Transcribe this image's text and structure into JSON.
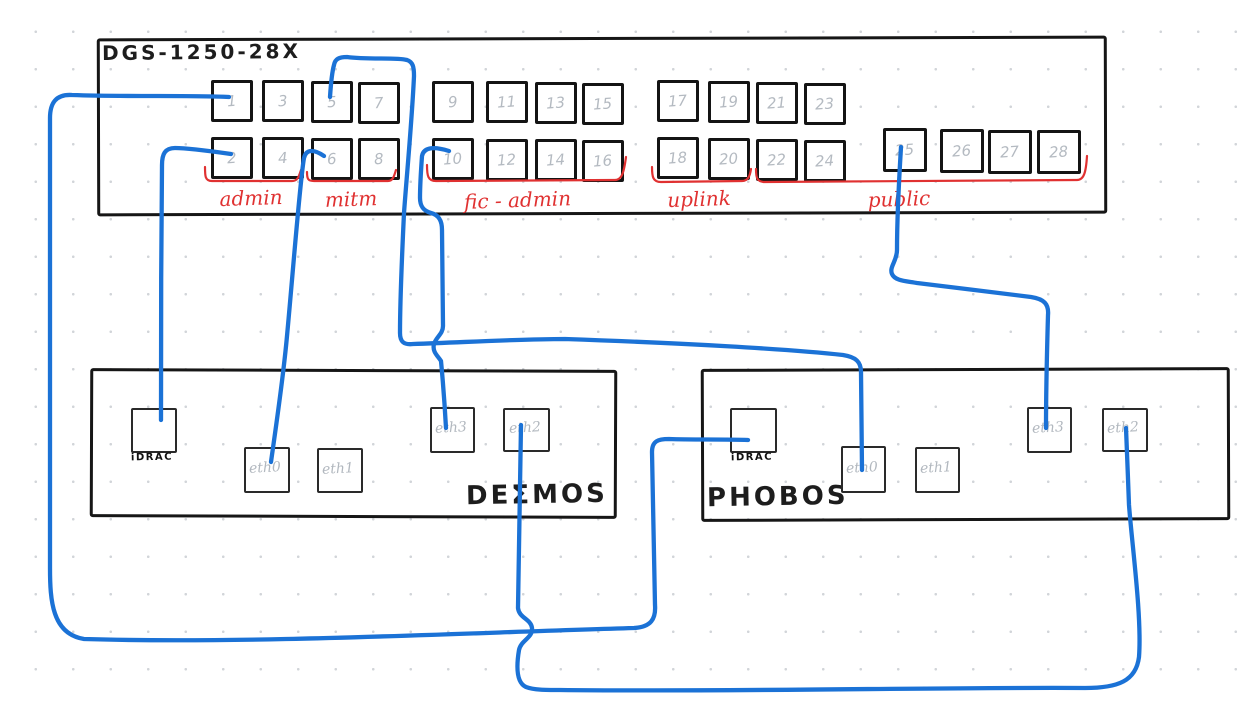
{
  "palette": {
    "cable_blue": "#1b72d6",
    "annotation_red": "#e03131",
    "ink_black": "#1d1d1d",
    "muted_gray": "#b4bac1",
    "background": "#ffffff"
  },
  "switch": {
    "title": "DGS-1250-28X",
    "port_numbers": [
      "1",
      "2",
      "3",
      "4",
      "5",
      "6",
      "7",
      "8",
      "9",
      "10",
      "11",
      "12",
      "13",
      "14",
      "15",
      "16",
      "17",
      "18",
      "19",
      "20",
      "21",
      "22",
      "23",
      "24",
      "25",
      "26",
      "27",
      "28"
    ],
    "groups": [
      {
        "label": "admin",
        "port_range": "1-4"
      },
      {
        "label": "mitm",
        "port_range": "5-8"
      },
      {
        "label": "fic - admin",
        "port_range": "9-16"
      },
      {
        "label": "uplink",
        "port_range": "17-20"
      },
      {
        "label": "public",
        "port_range": "21-28"
      }
    ]
  },
  "servers": [
    {
      "name": "DEΣMOS",
      "idrac_label": "iDRAC",
      "eth_labels": [
        "eth0",
        "eth1",
        "eth3",
        "eth2"
      ]
    },
    {
      "name": "PHOBOS",
      "idrac_label": "iDRAC",
      "eth_labels": [
        "eth0",
        "eth1",
        "eth3",
        "eth2"
      ]
    }
  ],
  "connections": [
    {
      "from": "switch-port-1",
      "to": "phobos-idrac"
    },
    {
      "from": "switch-port-2",
      "to": "deimos-idrac"
    },
    {
      "from": "switch-port-5",
      "to": "phobos-eth0"
    },
    {
      "from": "switch-port-6",
      "to": "deimos-eth0"
    },
    {
      "from": "switch-port-10",
      "to": "deimos-eth3"
    },
    {
      "from": "switch-port-25",
      "to": "phobos-eth3"
    },
    {
      "from": "deimos-eth2",
      "to": "phobos-eth2"
    }
  ]
}
